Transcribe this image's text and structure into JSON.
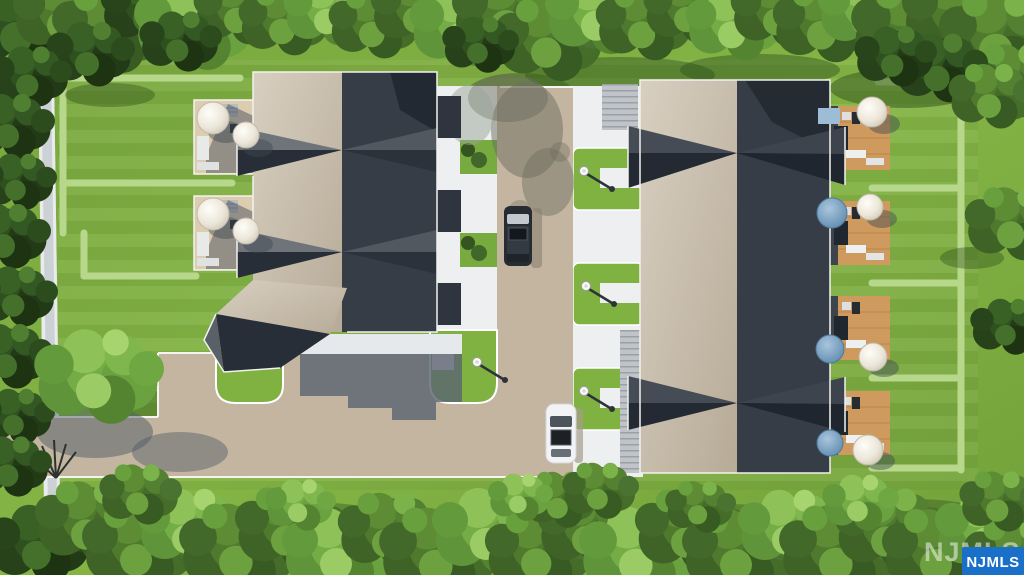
{
  "watermark": {
    "ghost_text": "NJMLS",
    "logo_text": "NJMLS",
    "logo_bg": "#1a6fc9",
    "logo_text_color": "#ffffff"
  },
  "palette": {
    "lawn": "#7fae41",
    "lawn_bright": "#8cbc4c",
    "tree_dark": "#2c4a1d",
    "roof_light": "#cdc3b2",
    "roof_dark": "#363d46",
    "driveway": "#c3b5a0",
    "concrete": "#edeff1",
    "sidewalk": "#ccd1d5",
    "deck_wood": "#cf9a5e",
    "umbrella_white": "#f1eee6",
    "umbrella_blue": "#7ca6c8",
    "hedge": "#b7d88b",
    "car_white": "#f2f3f4",
    "van_dark": "#272c33"
  }
}
